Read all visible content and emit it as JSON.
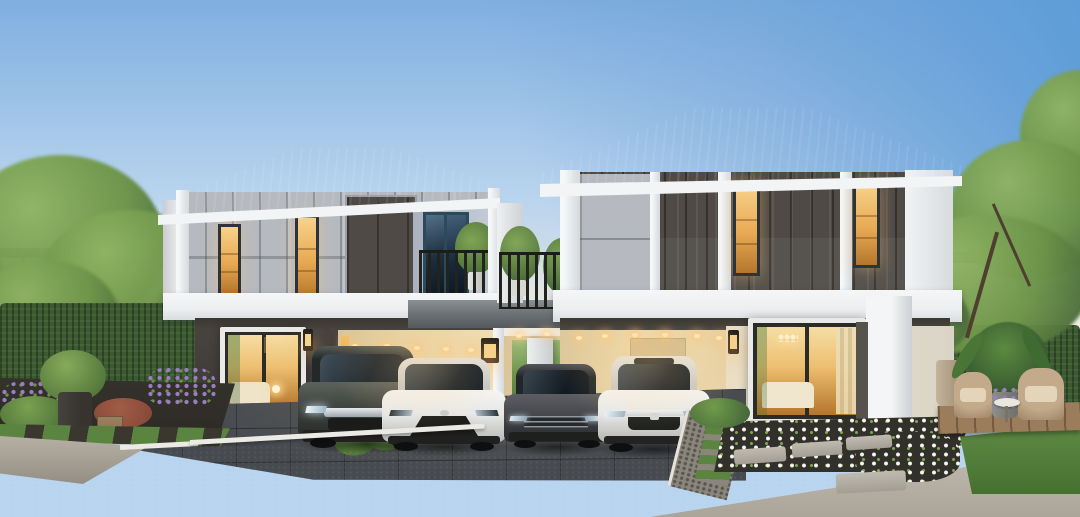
{
  "meta": {
    "title": "Twin two-storey modern houses at dusk — 3D architectural rendering",
    "canvas": {
      "width": 1080,
      "height": 517
    }
  },
  "colors": {
    "sky-top": "#7fafe0",
    "sky-mid": "#b9d4ee",
    "sky-deep": "#5e9dd8",
    "sky-horizon": "#efece2",
    "roof": "#1f2531",
    "roof-hi": "#3d4a60",
    "fascia": "#f2f4f5",
    "wall-white": "#eceef0",
    "panel-gray": "#b6bac0",
    "panel-dark": "#4f4a45",
    "charcoal-wall": "#48433f",
    "frame-dark": "#2c343a",
    "frame-teal": "#2c4a57",
    "frame-white": "#e9e9e7",
    "warm-hi": "#f7d28b",
    "warm-lo": "#b4762c",
    "carport-warm": "#e6d3a8",
    "beam-gray": "#6f7478",
    "soffit": "#3a3631",
    "glow": "#ffc878",
    "tree": "#6d9449",
    "tree-lite": "#8fb463",
    "tree-dark": "#48683a",
    "hedge": "#3b5a30",
    "grass": "#5a8440",
    "soil": "#32302a",
    "purple": "#9a7ec4",
    "flower-white": "#f6f4ee",
    "shrub-red": "#8a4a3a",
    "pot-dark": "#37332f",
    "wood": "#8a6e50",
    "deck": "#9b7d5c",
    "wicker": "#c3aa8b",
    "cushion": "#e3d4ba",
    "drive": "#474b50",
    "road-top": "#6b6760",
    "road-bot": "#4c4843",
    "sidewalk": "#b6b0a4",
    "apron": "#c2bcb0",
    "curb": "#eceae4",
    "gravel": "#8b867c",
    "car-dark": "#3f443f",
    "car-sedan-dark": "#46474b",
    "car-white": "#e9e9e7",
    "chrome": "#cfd3d6",
    "bg-building": "#ccd1d5",
    "bg-roof": "#3a404a",
    "bg-house": "#e8eae9"
  },
  "scene": {
    "setting": "residential street at dusk, interiors and carports lit warm",
    "sky": "clear blue, deeper toward upper right, pale warm haze at the horizon",
    "houses": [
      {
        "id": "house-left",
        "position": "left",
        "storeys": 2,
        "roof": "charcoal tiled hip roof with white fascia",
        "upper_facade": "light-grey vertical fibre-cement panels with a charcoal accent bay and two lit slot windows",
        "balcony": "recessed side balcony with teal-framed glass doors, black railing and potted trees",
        "ground_floor": "charcoal feature wall with large lit living-room window, black box sconce, double carport with recessed downlights"
      },
      {
        "id": "house-right",
        "position": "right",
        "storeys": 2,
        "roof": "charcoal tiled hip roof with white fascia",
        "upper_facade": "charcoal vertical panels with white pilasters, grey corner panel and two lit slot windows",
        "balcony": "connecting planted balcony over the breezeway between the houses",
        "ground_floor": "cream lit walls, large glass sliding door to a lit living room, double carport with downlights"
      }
    ],
    "cars": [
      {
        "id": "car-1",
        "type": "compact SUV",
        "color_name": "dark grey",
        "parked": "left carport"
      },
      {
        "id": "car-2",
        "type": "sedan",
        "color_name": "white",
        "parked": "left carport"
      },
      {
        "id": "car-3",
        "type": "fastback sedan",
        "color_name": "dark grey",
        "parked": "right carport"
      },
      {
        "id": "car-4",
        "type": "sedan",
        "color_name": "white",
        "parked": "right carport"
      }
    ],
    "landscape": {
      "left_garden": "lavender-purple flower bed, ferns, red-leaf shrub, black planter pot and timber planter box set in dark gravel with grass strips",
      "middle": "low clipped hedge strip between the two paver driveways",
      "right_garden": "white flower bed, stepping-stone path with grass joints, clipped hedge wall, timber deck with two wicker armchairs, side table, tall planter, banana-leaf plant and purple flowers",
      "background": "street trees, row of townhouses on the left, white detached house on the right"
    },
    "foreground": {
      "driveways": "dark grey paver driveways with white kerb edging",
      "road": "dark asphalt street across the bottom",
      "sidewalk": "light concrete aprons at both lower corners"
    },
    "lighting": [
      "warm recessed downlights in carport soffits",
      "black box wall sconces glowing warm",
      "lit interior rooms visible through windows"
    ]
  }
}
